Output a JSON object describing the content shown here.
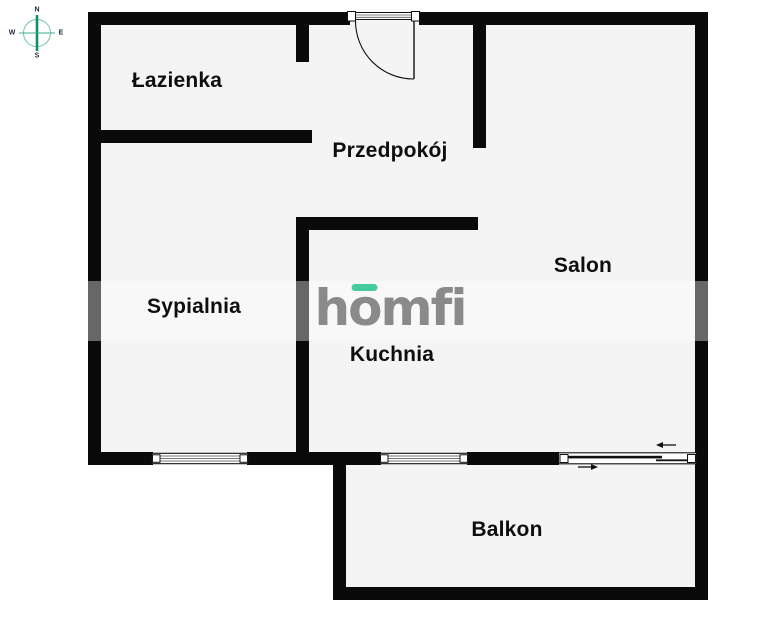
{
  "compass": {
    "north": "N",
    "south": "S",
    "west": "W",
    "east": "E"
  },
  "rooms": {
    "lazienka": "Łazienka",
    "przedpokoj": "Przedpokój",
    "sypialnia": "Sypialnia",
    "kuchnia": "Kuchnia",
    "salon": "Salon",
    "balkon": "Balkon"
  },
  "logo": {
    "h": "h",
    "o": "o",
    "rest": "mfi"
  },
  "colors": {
    "wall": "#0a0a0a",
    "floor": "#f4f4f5",
    "background": "#ffffff",
    "logo_text": "#8a8a8a",
    "logo_accent": "#45cc9d",
    "compass_needle": "#0d8f69",
    "compass_ring": "#6cc7a9",
    "label_text": "#0e0e0e"
  }
}
